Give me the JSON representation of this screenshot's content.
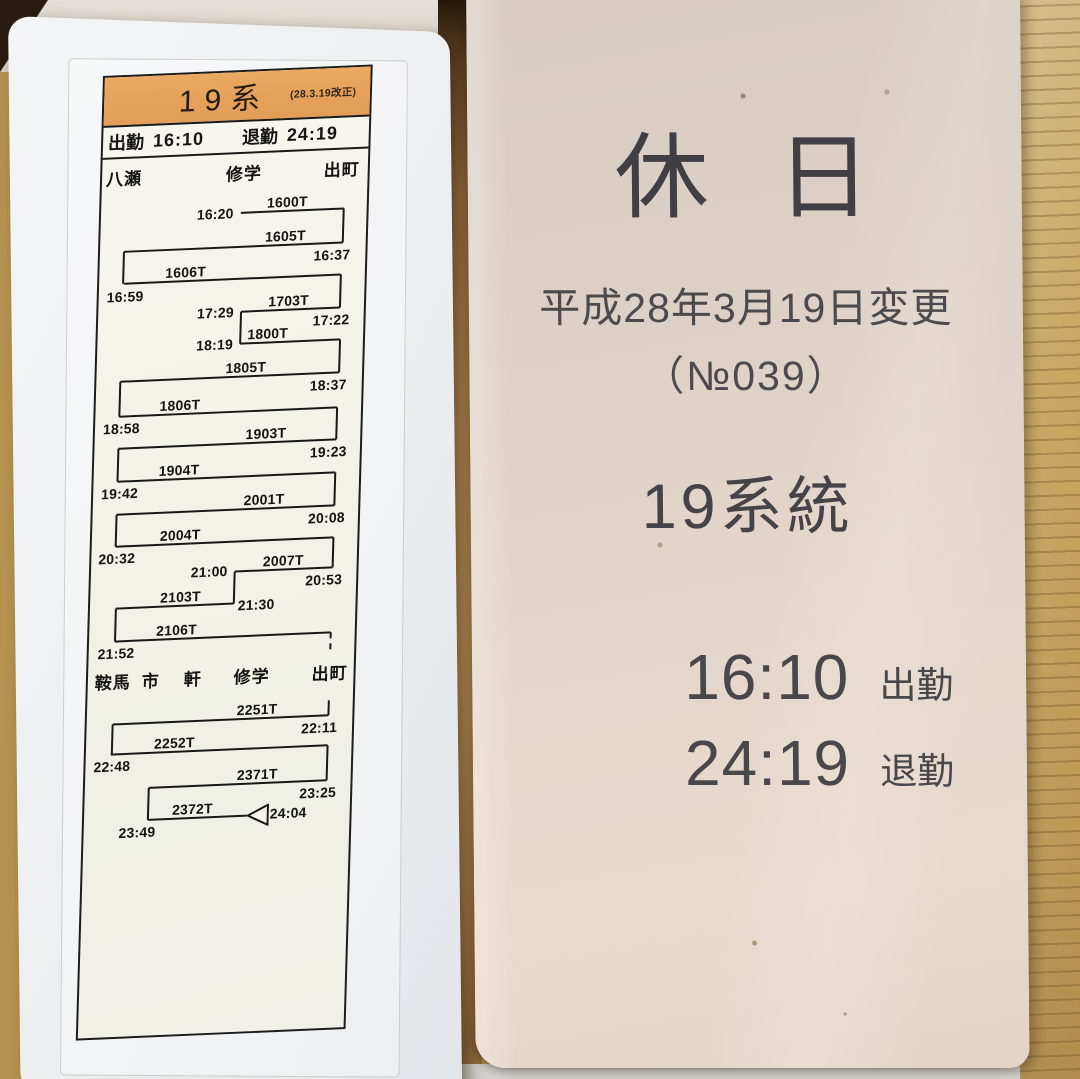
{
  "left_card": {
    "header": {
      "route_title": "19系",
      "revision_note": "(28.3.19改正)"
    },
    "duty_row": {
      "start_label": "出勤",
      "start_time": "16:10",
      "end_label": "退勤",
      "end_time": "24:19"
    },
    "diagram": {
      "station_rows": [
        {
          "y": 88,
          "stations": [
            {
              "label": "八瀬",
              "x": 4
            },
            {
              "label": "修学",
              "x": 124
            },
            {
              "label": "出町",
              "x": 222
            }
          ]
        },
        {
          "y": 592,
          "stations": [
            {
              "label": "鞍馬",
              "x": 7
            },
            {
              "label": "市",
              "x": 54
            },
            {
              "label": "軒",
              "x": 96
            },
            {
              "label": "修学",
              "x": 146
            },
            {
              "label": "出町",
              "x": 224
            }
          ]
        }
      ],
      "runs": [
        {
          "train": "1600T",
          "y": 141,
          "x1": 140,
          "x2": 243,
          "label_x": 166,
          "times": [
            {
              "t": "16:20",
              "x": 96,
              "dy": -8
            }
          ]
        },
        {
          "train": "1605T",
          "y": 175,
          "x1": 24,
          "x2": 243,
          "label_x": 165,
          "times": [
            {
              "t": "16:37",
              "x": 214,
              "dy": 4
            }
          ]
        },
        {
          "train": "1606T",
          "y": 207,
          "x1": 25,
          "x2": 242,
          "label_x": 66,
          "times": [
            {
              "t": "16:59",
              "x": 8,
              "dy": 5
            }
          ]
        },
        {
          "train": "1703T",
          "y": 240,
          "x1": 143,
          "x2": 242,
          "label_x": 170,
          "times": [
            {
              "t": "17:29",
              "x": 99,
              "dy": -8
            },
            {
              "t": "17:22",
              "x": 215,
              "dy": 4
            }
          ]
        },
        {
          "train": "1800T",
          "y": 272,
          "x1": 143,
          "x2": 243,
          "label_x": 150,
          "times": [
            {
              "t": "18:19",
              "x": 99,
              "dy": -8
            }
          ]
        },
        {
          "train": "1805T",
          "y": 305,
          "x1": 24,
          "x2": 243,
          "label_x": 129,
          "times": [
            {
              "t": "18:37",
              "x": 214,
              "dy": 4
            }
          ]
        },
        {
          "train": "1806T",
          "y": 340,
          "x1": 24,
          "x2": 242,
          "label_x": 64,
          "times": [
            {
              "t": "18:58",
              "x": 8,
              "dy": 4
            }
          ]
        },
        {
          "train": "1903T",
          "y": 372,
          "x1": 24,
          "x2": 242,
          "label_x": 151,
          "times": [
            {
              "t": "19:23",
              "x": 216,
              "dy": 4
            }
          ]
        },
        {
          "train": "1904T",
          "y": 405,
          "x1": 24,
          "x2": 242,
          "label_x": 65,
          "times": [
            {
              "t": "19:42",
              "x": 8,
              "dy": 4
            }
          ]
        },
        {
          "train": "2001T",
          "y": 438,
          "x1": 24,
          "x2": 242,
          "label_x": 151,
          "times": [
            {
              "t": "20:08",
              "x": 216,
              "dy": 4
            }
          ]
        },
        {
          "train": "2004T",
          "y": 470,
          "x1": 24,
          "x2": 242,
          "label_x": 68,
          "times": [
            {
              "t": "20:32",
              "x": 7,
              "dy": 4
            }
          ]
        },
        {
          "train": "2007T",
          "y": 500,
          "x1": 144,
          "x2": 242,
          "label_x": 172,
          "times": [
            {
              "t": "21:00",
              "x": 100,
              "dy": -9
            },
            {
              "t": "20:53",
              "x": 215,
              "dy": 4
            }
          ]
        },
        {
          "train": "2103T",
          "y": 532,
          "x1": 26,
          "x2": 144,
          "label_x": 70,
          "times": [
            {
              "t": "21:30",
              "x": 148,
              "dy": -6
            }
          ]
        },
        {
          "train": "2106T",
          "y": 565,
          "x1": 26,
          "x2": 242,
          "label_x": 67,
          "times": [
            {
              "t": "21:52",
              "x": 9,
              "dy": 4
            }
          ]
        },
        {
          "train": "2251T",
          "y": 648,
          "x1": 26,
          "x2": 242,
          "label_x": 150,
          "times": [
            {
              "t": "22:11",
              "x": 215,
              "dy": 4
            }
          ]
        },
        {
          "train": "2252T",
          "y": 678,
          "x1": 25,
          "x2": 242,
          "label_x": 68,
          "times": [
            {
              "t": "22:48",
              "x": 8,
              "dy": 4
            }
          ]
        },
        {
          "train": "2371T",
          "y": 713,
          "x1": 64,
          "x2": 242,
          "label_x": 152,
          "times": [
            {
              "t": "23:25",
              "x": 215,
              "dy": 4
            }
          ]
        },
        {
          "train": "2372T",
          "y": 745,
          "x1": 64,
          "x2": 163,
          "label_x": 88,
          "times": [
            {
              "t": "23:49",
              "x": 35,
              "dy": 4
            },
            {
              "t": "24:04",
              "x": 186,
              "dy": -9
            }
          ]
        }
      ],
      "connectors": [
        {
          "x": 243,
          "y1": 141,
          "y2": 175
        },
        {
          "x": 24,
          "y1": 175,
          "y2": 207
        },
        {
          "x": 242,
          "y1": 207,
          "y2": 240
        },
        {
          "x": 143,
          "y1": 240,
          "y2": 272
        },
        {
          "x": 243,
          "y1": 272,
          "y2": 305
        },
        {
          "x": 24,
          "y1": 305,
          "y2": 340
        },
        {
          "x": 242,
          "y1": 340,
          "y2": 372
        },
        {
          "x": 24,
          "y1": 372,
          "y2": 405
        },
        {
          "x": 242,
          "y1": 405,
          "y2": 438
        },
        {
          "x": 24,
          "y1": 438,
          "y2": 470
        },
        {
          "x": 242,
          "y1": 470,
          "y2": 500
        },
        {
          "x": 144,
          "y1": 500,
          "y2": 532
        },
        {
          "x": 26,
          "y1": 532,
          "y2": 565
        },
        {
          "x": 242,
          "y1": 565,
          "y2": 582,
          "dashed": true
        },
        {
          "x": 242,
          "y1": 633,
          "y2": 648
        },
        {
          "x": 26,
          "y1": 648,
          "y2": 678
        },
        {
          "x": 242,
          "y1": 678,
          "y2": 713
        },
        {
          "x": 64,
          "y1": 713,
          "y2": 745
        }
      ],
      "end_marker": {
        "x": 163,
        "y": 745
      }
    }
  },
  "right_card": {
    "day_type": "休 日",
    "revision_date": "平成28年3月19日変更",
    "card_number": "（№039）",
    "route_title": "19系統",
    "duties": [
      {
        "time": "16:10",
        "label": "出勤"
      },
      {
        "time": "24:19",
        "label": "退勤"
      }
    ]
  }
}
